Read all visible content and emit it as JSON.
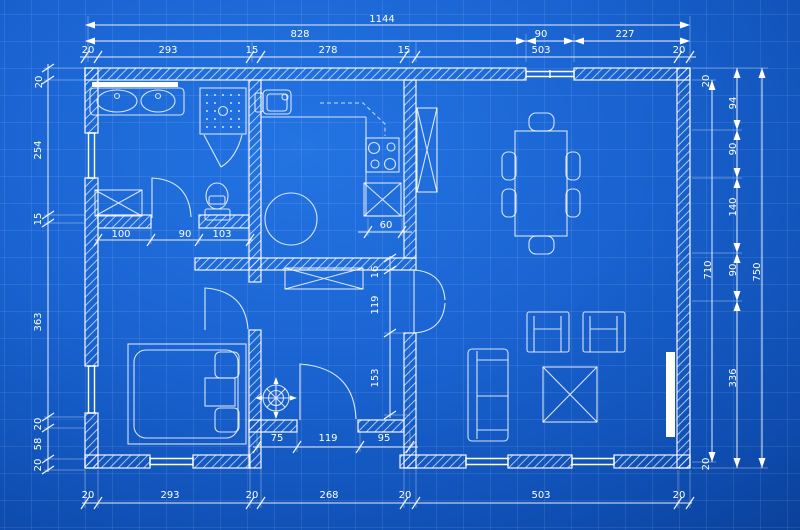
{
  "meta": {
    "drawing_type": "floor-plan-blueprint"
  },
  "colors": {
    "background_center": "#2474e4",
    "background_edge": "#072f78",
    "line_white": "#ffffff",
    "grid_line": "rgba(255,255,255,0.085)"
  },
  "dimension_labels": [
    {
      "text": "1144",
      "x": 382,
      "y": 22,
      "rot": 0,
      "group": "top-total"
    },
    {
      "text": "828",
      "x": 300,
      "y": 37,
      "rot": 0,
      "group": "top-row2"
    },
    {
      "text": "90",
      "x": 541,
      "y": 37,
      "rot": 0,
      "group": "top-row2"
    },
    {
      "text": "227",
      "x": 625,
      "y": 37,
      "rot": 0,
      "group": "top-row2"
    },
    {
      "text": "20",
      "x": 88,
      "y": 53,
      "rot": 0,
      "group": "top-row3"
    },
    {
      "text": "293",
      "x": 168,
      "y": 53,
      "rot": 0,
      "group": "top-row3"
    },
    {
      "text": "15",
      "x": 252,
      "y": 53,
      "rot": 0,
      "group": "top-row3"
    },
    {
      "text": "278",
      "x": 328,
      "y": 53,
      "rot": 0,
      "group": "top-row3"
    },
    {
      "text": "15",
      "x": 404,
      "y": 53,
      "rot": 0,
      "group": "top-row3"
    },
    {
      "text": "503",
      "x": 541,
      "y": 53,
      "rot": 0,
      "group": "top-row3"
    },
    {
      "text": "20",
      "x": 679,
      "y": 53,
      "rot": 0,
      "group": "top-row3"
    },
    {
      "text": "20",
      "x": 42,
      "y": 82,
      "rot": -90,
      "group": "left"
    },
    {
      "text": "254",
      "x": 41,
      "y": 150,
      "rot": -90,
      "group": "left"
    },
    {
      "text": "15",
      "x": 41,
      "y": 219,
      "rot": -90,
      "group": "left"
    },
    {
      "text": "363",
      "x": 41,
      "y": 322,
      "rot": -90,
      "group": "left"
    },
    {
      "text": "20",
      "x": 41,
      "y": 424,
      "rot": -90,
      "group": "left"
    },
    {
      "text": "58",
      "x": 41,
      "y": 444,
      "rot": -90,
      "group": "left"
    },
    {
      "text": "20",
      "x": 41,
      "y": 465,
      "rot": -90,
      "group": "left"
    },
    {
      "text": "20",
      "x": 709,
      "y": 81,
      "rot": -90,
      "group": "right"
    },
    {
      "text": "94",
      "x": 736,
      "y": 103,
      "rot": -90,
      "group": "right"
    },
    {
      "text": "90",
      "x": 736,
      "y": 149,
      "rot": -90,
      "group": "right"
    },
    {
      "text": "140",
      "x": 736,
      "y": 207,
      "rot": -90,
      "group": "right"
    },
    {
      "text": "90",
      "x": 736,
      "y": 270,
      "rot": -90,
      "group": "right"
    },
    {
      "text": "710",
      "x": 711,
      "y": 270,
      "rot": -90,
      "group": "right"
    },
    {
      "text": "750",
      "x": 760,
      "y": 272,
      "rot": -90,
      "group": "right"
    },
    {
      "text": "336",
      "x": 736,
      "y": 378,
      "rot": -90,
      "group": "right"
    },
    {
      "text": "20",
      "x": 709,
      "y": 464,
      "rot": -90,
      "group": "right"
    },
    {
      "text": "20",
      "x": 88,
      "y": 498,
      "rot": 0,
      "group": "bottom"
    },
    {
      "text": "293",
      "x": 170,
      "y": 498,
      "rot": 0,
      "group": "bottom"
    },
    {
      "text": "20",
      "x": 252,
      "y": 498,
      "rot": 0,
      "group": "bottom"
    },
    {
      "text": "268",
      "x": 329,
      "y": 498,
      "rot": 0,
      "group": "bottom"
    },
    {
      "text": "20",
      "x": 405,
      "y": 498,
      "rot": 0,
      "group": "bottom"
    },
    {
      "text": "503",
      "x": 541,
      "y": 498,
      "rot": 0,
      "group": "bottom"
    },
    {
      "text": "20",
      "x": 679,
      "y": 498,
      "rot": 0,
      "group": "bottom"
    },
    {
      "text": "100",
      "x": 121,
      "y": 237,
      "rot": 0,
      "group": "interior"
    },
    {
      "text": "90",
      "x": 185,
      "y": 237,
      "rot": 0,
      "group": "interior"
    },
    {
      "text": "103",
      "x": 222,
      "y": 237,
      "rot": 0,
      "group": "interior"
    },
    {
      "text": "60",
      "x": 386,
      "y": 228,
      "rot": 0,
      "group": "interior"
    },
    {
      "text": "16",
      "x": 378,
      "y": 272,
      "rot": -90,
      "group": "interior"
    },
    {
      "text": "119",
      "x": 378,
      "y": 305,
      "rot": -90,
      "group": "interior"
    },
    {
      "text": "153",
      "x": 378,
      "y": 378,
      "rot": -90,
      "group": "interior"
    },
    {
      "text": "75",
      "x": 277,
      "y": 441,
      "rot": 0,
      "group": "interior"
    },
    {
      "text": "119",
      "x": 328,
      "y": 441,
      "rot": 0,
      "group": "interior"
    },
    {
      "text": "95",
      "x": 384,
      "y": 441,
      "rot": 0,
      "group": "interior"
    }
  ]
}
